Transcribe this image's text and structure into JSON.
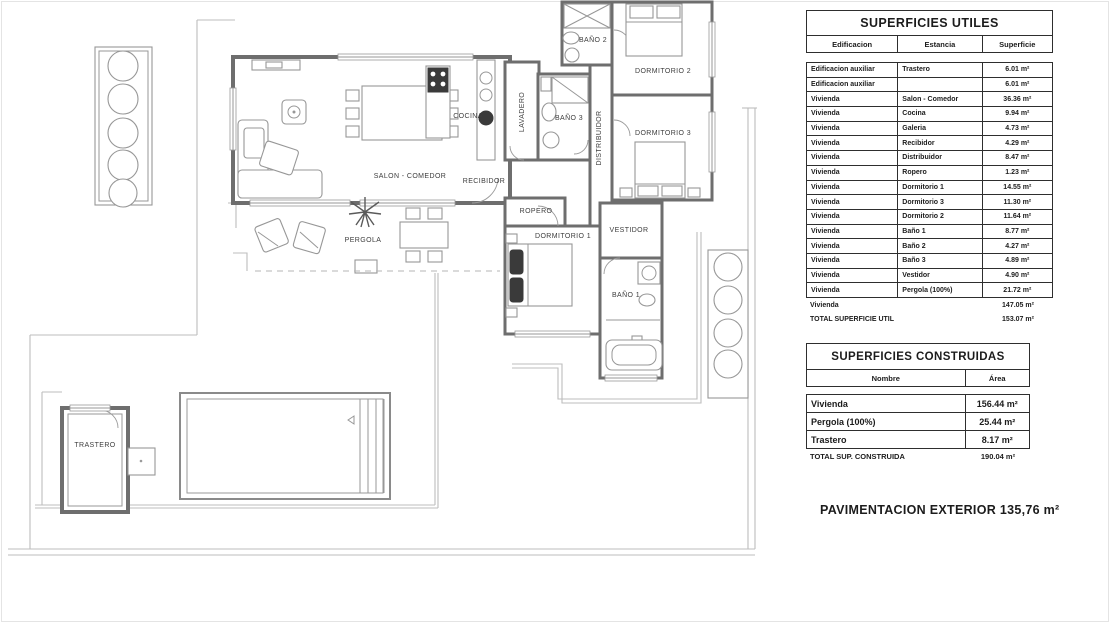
{
  "floor_plan": {
    "rooms": [
      {
        "id": "salon",
        "label": "SALON - COMEDOR"
      },
      {
        "id": "cocina",
        "label": "COCINA"
      },
      {
        "id": "lavadero",
        "label": "LAVADERO"
      },
      {
        "id": "recibidor",
        "label": "RECIBIDOR"
      },
      {
        "id": "bano2",
        "label": "BAÑO 2"
      },
      {
        "id": "dormitorio2",
        "label": "DORMITORIO 2"
      },
      {
        "id": "bano3",
        "label": "BAÑO 3"
      },
      {
        "id": "distribuidor",
        "label": "DISTRIBUIDOR"
      },
      {
        "id": "dormitorio3",
        "label": "DORMITORIO 3"
      },
      {
        "id": "ropero",
        "label": "ROPERO"
      },
      {
        "id": "dormitorio1",
        "label": "DORMITORIO 1"
      },
      {
        "id": "vestidor",
        "label": "VESTIDOR"
      },
      {
        "id": "bano1",
        "label": "BAÑO 1"
      },
      {
        "id": "pergola",
        "label": "PERGOLA"
      },
      {
        "id": "trastero",
        "label": "TRASTERO"
      }
    ]
  },
  "tables": {
    "superficies_utiles": {
      "title": "SUPERFICIES UTILES",
      "columns": [
        "Edificacion",
        "Estancia",
        "Superficie"
      ],
      "rows": [
        [
          "Edificacion auxiliar",
          "Trastero",
          "6.01 m²"
        ],
        [
          "Edificacion auxiliar",
          "",
          "6.01 m²"
        ],
        [
          "Vivienda",
          "Salon - Comedor",
          "36.36 m²"
        ],
        [
          "Vivienda",
          "Cocina",
          "9.94 m²"
        ],
        [
          "Vivienda",
          "Galeria",
          "4.73 m²"
        ],
        [
          "Vivienda",
          "Recibidor",
          "4.29 m²"
        ],
        [
          "Vivienda",
          "Distribuidor",
          "8.47 m²"
        ],
        [
          "Vivienda",
          "Ropero",
          "1.23 m²"
        ],
        [
          "Vivienda",
          "Dormitorio 1",
          "14.55 m²"
        ],
        [
          "Vivienda",
          "Dormitorio 3",
          "11.30 m²"
        ],
        [
          "Vivienda",
          "Dormitorio 2",
          "11.64 m²"
        ],
        [
          "Vivienda",
          "Baño 1",
          "8.77 m²"
        ],
        [
          "Vivienda",
          "Baño 2",
          "4.27 m²"
        ],
        [
          "Vivienda",
          "Baño 3",
          "4.89 m²"
        ],
        [
          "Vivienda",
          "Vestidor",
          "4.90 m²"
        ],
        [
          "Vivienda",
          "Pergola  (100%)",
          "21.72 m²"
        ]
      ],
      "summary": [
        [
          "Vivienda",
          "147.05 m²"
        ],
        [
          "TOTAL SUPERFICIE UTIL",
          "153.07 m²"
        ]
      ]
    },
    "superficies_construidas": {
      "title": "SUPERFICIES CONSTRUIDAS",
      "columns": [
        "Nombre",
        "Área"
      ],
      "rows": [
        [
          "Vivienda",
          "156.44 m²"
        ],
        [
          "Pergola  (100%)",
          "25.44 m²"
        ],
        [
          "Trastero",
          "8.17 m²"
        ]
      ],
      "summary": [
        [
          "TOTAL SUP. CONSTRUIDA",
          "190.04 m²"
        ]
      ]
    }
  },
  "footer_note": "PAVIMENTACION EXTERIOR 135,76 m²"
}
